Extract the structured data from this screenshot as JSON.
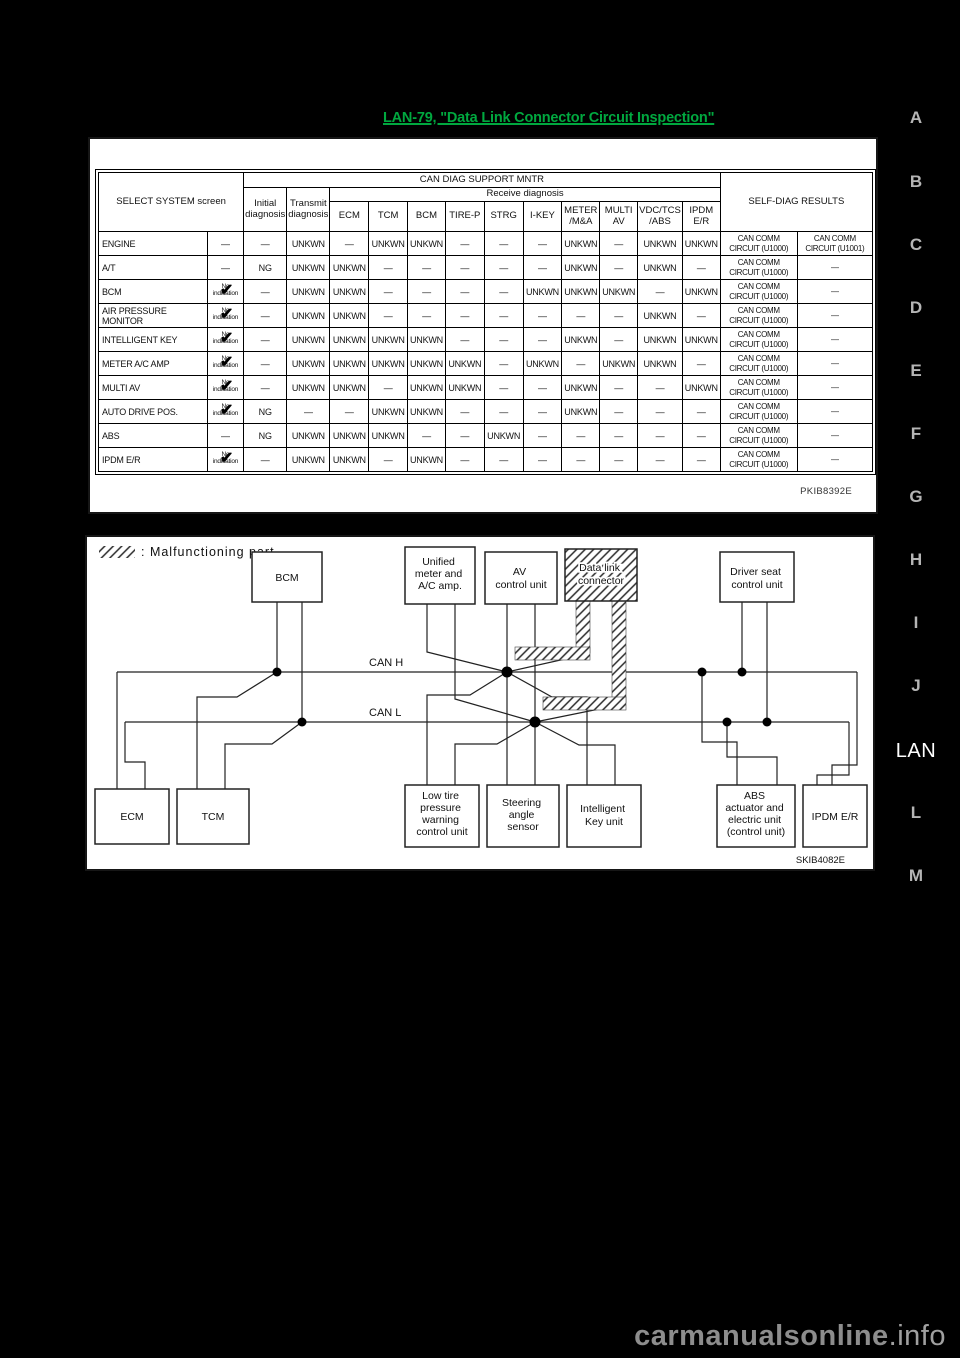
{
  "page": {
    "link_text": "LAN-79, \"Data Link Connector Circuit Inspection\"",
    "figure_code_table": "PKIB8392E",
    "figure_code_diagram": "SKIB4082E",
    "watermark_main": "carmanualsonline",
    "watermark_suffix": ".info",
    "accent_green": "#00a83f"
  },
  "side_tabs": {
    "items": [
      "A",
      "B",
      "C",
      "D",
      "E",
      "F",
      "G",
      "H",
      "I",
      "J",
      "LAN",
      "L",
      "M"
    ],
    "active": "LAN"
  },
  "table": {
    "header": {
      "select_system": "SELECT SYSTEM screen",
      "can_diag": "CAN DIAG SUPPORT MNTR",
      "receive": "Receive diagnosis",
      "initial": "Initial diagnosis",
      "transmit": "Transmit diagnosis",
      "units": [
        "ECM",
        "TCM",
        "BCM",
        "TIRE-P",
        "STRG",
        "I-KEY",
        "METER /M&A",
        "MULTI AV",
        "VDC/TCS /ABS",
        "IPDM E/R"
      ],
      "self_diag": "SELF-DIAG RESULTS"
    },
    "no_indication_line1": "No",
    "no_indication_line2": "indication",
    "dash": "—",
    "rows": [
      {
        "name": "ENGINE",
        "ind": "—",
        "values": [
          "—",
          "UNKWN",
          "—",
          "UNKWN",
          "UNKWN",
          "—",
          "—",
          "—",
          "UNKWN",
          "—",
          "UNKWN",
          "UNKWN"
        ],
        "sd1": "CAN COMM CIRCUIT (U1000)",
        "sd2": "CAN COMM CIRCUIT (U1001)"
      },
      {
        "name": "A/T",
        "ind": "—",
        "values": [
          "NG",
          "UNKWN",
          "UNKWN",
          "—",
          "—",
          "—",
          "—",
          "—",
          "UNKWN",
          "—",
          "UNKWN",
          "—"
        ],
        "sd1": "CAN COMM CIRCUIT (U1000)",
        "sd2": "—"
      },
      {
        "name": "BCM",
        "ind": "NOIND",
        "values": [
          "—",
          "UNKWN",
          "UNKWN",
          "—",
          "—",
          "—",
          "—",
          "UNKWN",
          "UNKWN",
          "UNKWN",
          "—",
          "UNKWN"
        ],
        "sd1": "CAN COMM CIRCUIT (U1000)",
        "sd2": "—"
      },
      {
        "name": "AIR PRESSURE MONITOR",
        "ind": "NOIND",
        "values": [
          "—",
          "UNKWN",
          "UNKWN",
          "—",
          "—",
          "—",
          "—",
          "—",
          "—",
          "—",
          "UNKWN",
          "—"
        ],
        "sd1": "CAN COMM CIRCUIT (U1000)",
        "sd2": "—"
      },
      {
        "name": "INTELLIGENT KEY",
        "ind": "NOIND",
        "values": [
          "—",
          "UNKWN",
          "UNKWN",
          "UNKWN",
          "UNKWN",
          "—",
          "—",
          "—",
          "UNKWN",
          "—",
          "UNKWN",
          "UNKWN"
        ],
        "sd1": "CAN COMM CIRCUIT (U1000)",
        "sd2": "—"
      },
      {
        "name": "METER A/C AMP",
        "ind": "NOIND",
        "values": [
          "—",
          "UNKWN",
          "UNKWN",
          "UNKWN",
          "UNKWN",
          "UNKWN",
          "—",
          "UNKWN",
          "—",
          "UNKWN",
          "UNKWN",
          "—"
        ],
        "sd1": "CAN COMM CIRCUIT (U1000)",
        "sd2": "—"
      },
      {
        "name": "MULTI AV",
        "ind": "NOIND",
        "values": [
          "—",
          "UNKWN",
          "UNKWN",
          "—",
          "UNKWN",
          "UNKWN",
          "—",
          "—",
          "UNKWN",
          "—",
          "—",
          "UNKWN"
        ],
        "sd1": "CAN COMM CIRCUIT (U1000)",
        "sd2": "—"
      },
      {
        "name": "AUTO DRIVE POS.",
        "ind": "NOIND",
        "values": [
          "NG",
          "—",
          "—",
          "UNKWN",
          "UNKWN",
          "—",
          "—",
          "—",
          "UNKWN",
          "—",
          "—",
          "—"
        ],
        "sd1": "CAN COMM CIRCUIT (U1000)",
        "sd2": "—"
      },
      {
        "name": "ABS",
        "ind": "—",
        "values": [
          "NG",
          "UNKWN",
          "UNKWN",
          "UNKWN",
          "—",
          "—",
          "UNKWN",
          "—",
          "—",
          "—",
          "—",
          "—"
        ],
        "sd1": "CAN COMM CIRCUIT (U1000)",
        "sd2": "—"
      },
      {
        "name": "IPDM E/R",
        "ind": "NOIND",
        "values": [
          "—",
          "UNKWN",
          "UNKWN",
          "—",
          "UNKWN",
          "—",
          "—",
          "—",
          "—",
          "—",
          "—",
          "—"
        ],
        "sd1": "CAN COMM CIRCUIT (U1000)",
        "sd2": "—"
      }
    ]
  },
  "diagram": {
    "legend": ": Malfunctioning part",
    "bus_h": "CAN H",
    "bus_l": "CAN L",
    "boxes": {
      "bcm": [
        "BCM"
      ],
      "unified": [
        "Unified",
        "meter and",
        "A/C amp."
      ],
      "av": [
        "AV",
        "control unit"
      ],
      "dlc": [
        "Data link",
        "connector"
      ],
      "driver_seat": [
        "Driver seat",
        "control unit"
      ],
      "ecm": [
        "ECM"
      ],
      "tcm": [
        "TCM"
      ],
      "low_tire": [
        "Low tire",
        "pressure",
        "warning",
        "control unit"
      ],
      "steering": [
        "Steering",
        "angle",
        "sensor"
      ],
      "intelligent_key": [
        "Intelligent",
        "Key unit"
      ],
      "abs_unit": [
        "ABS",
        "actuator and",
        "electric unit",
        "(control unit)"
      ],
      "ipdm": [
        "IPDM E/R"
      ]
    }
  }
}
